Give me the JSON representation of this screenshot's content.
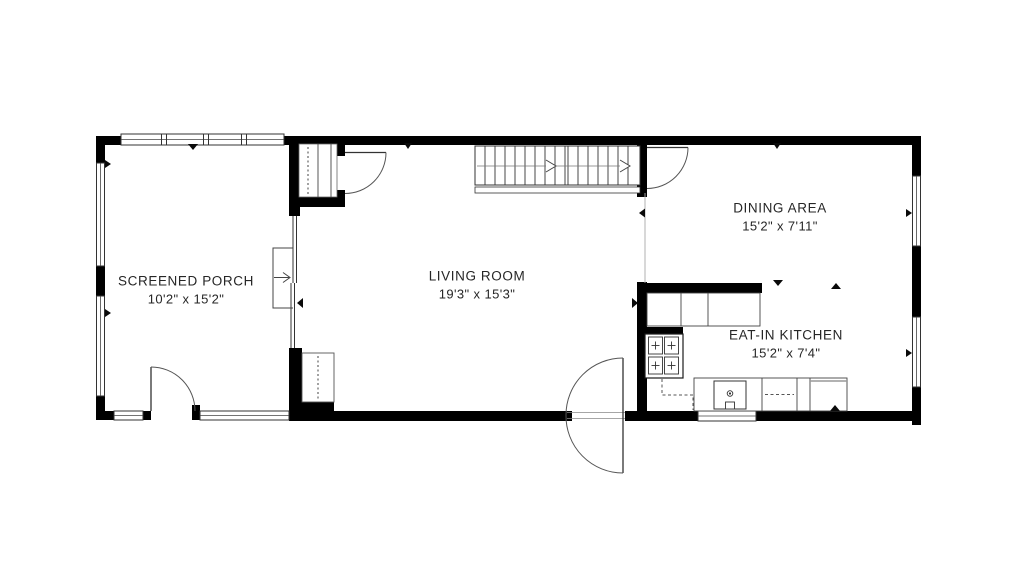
{
  "palette": {
    "walls": "#000000",
    "lines": "#3f3f3f",
    "background": "#ffffff",
    "text": "#262626"
  },
  "rooms": [
    {
      "id": "screened-porch",
      "name": "SCREENED PORCH",
      "dimensions": "10'2\" x 15'2\""
    },
    {
      "id": "living-room",
      "name": "LIVING ROOM",
      "dimensions": "19'3\" x 15'3\""
    },
    {
      "id": "dining-area",
      "name": "DINING AREA",
      "dimensions": "15'2\" x 7'11\""
    },
    {
      "id": "eat-in-kitchen",
      "name": "EAT-IN KITCHEN",
      "dimensions": "15'2\" x 7'4\""
    }
  ]
}
